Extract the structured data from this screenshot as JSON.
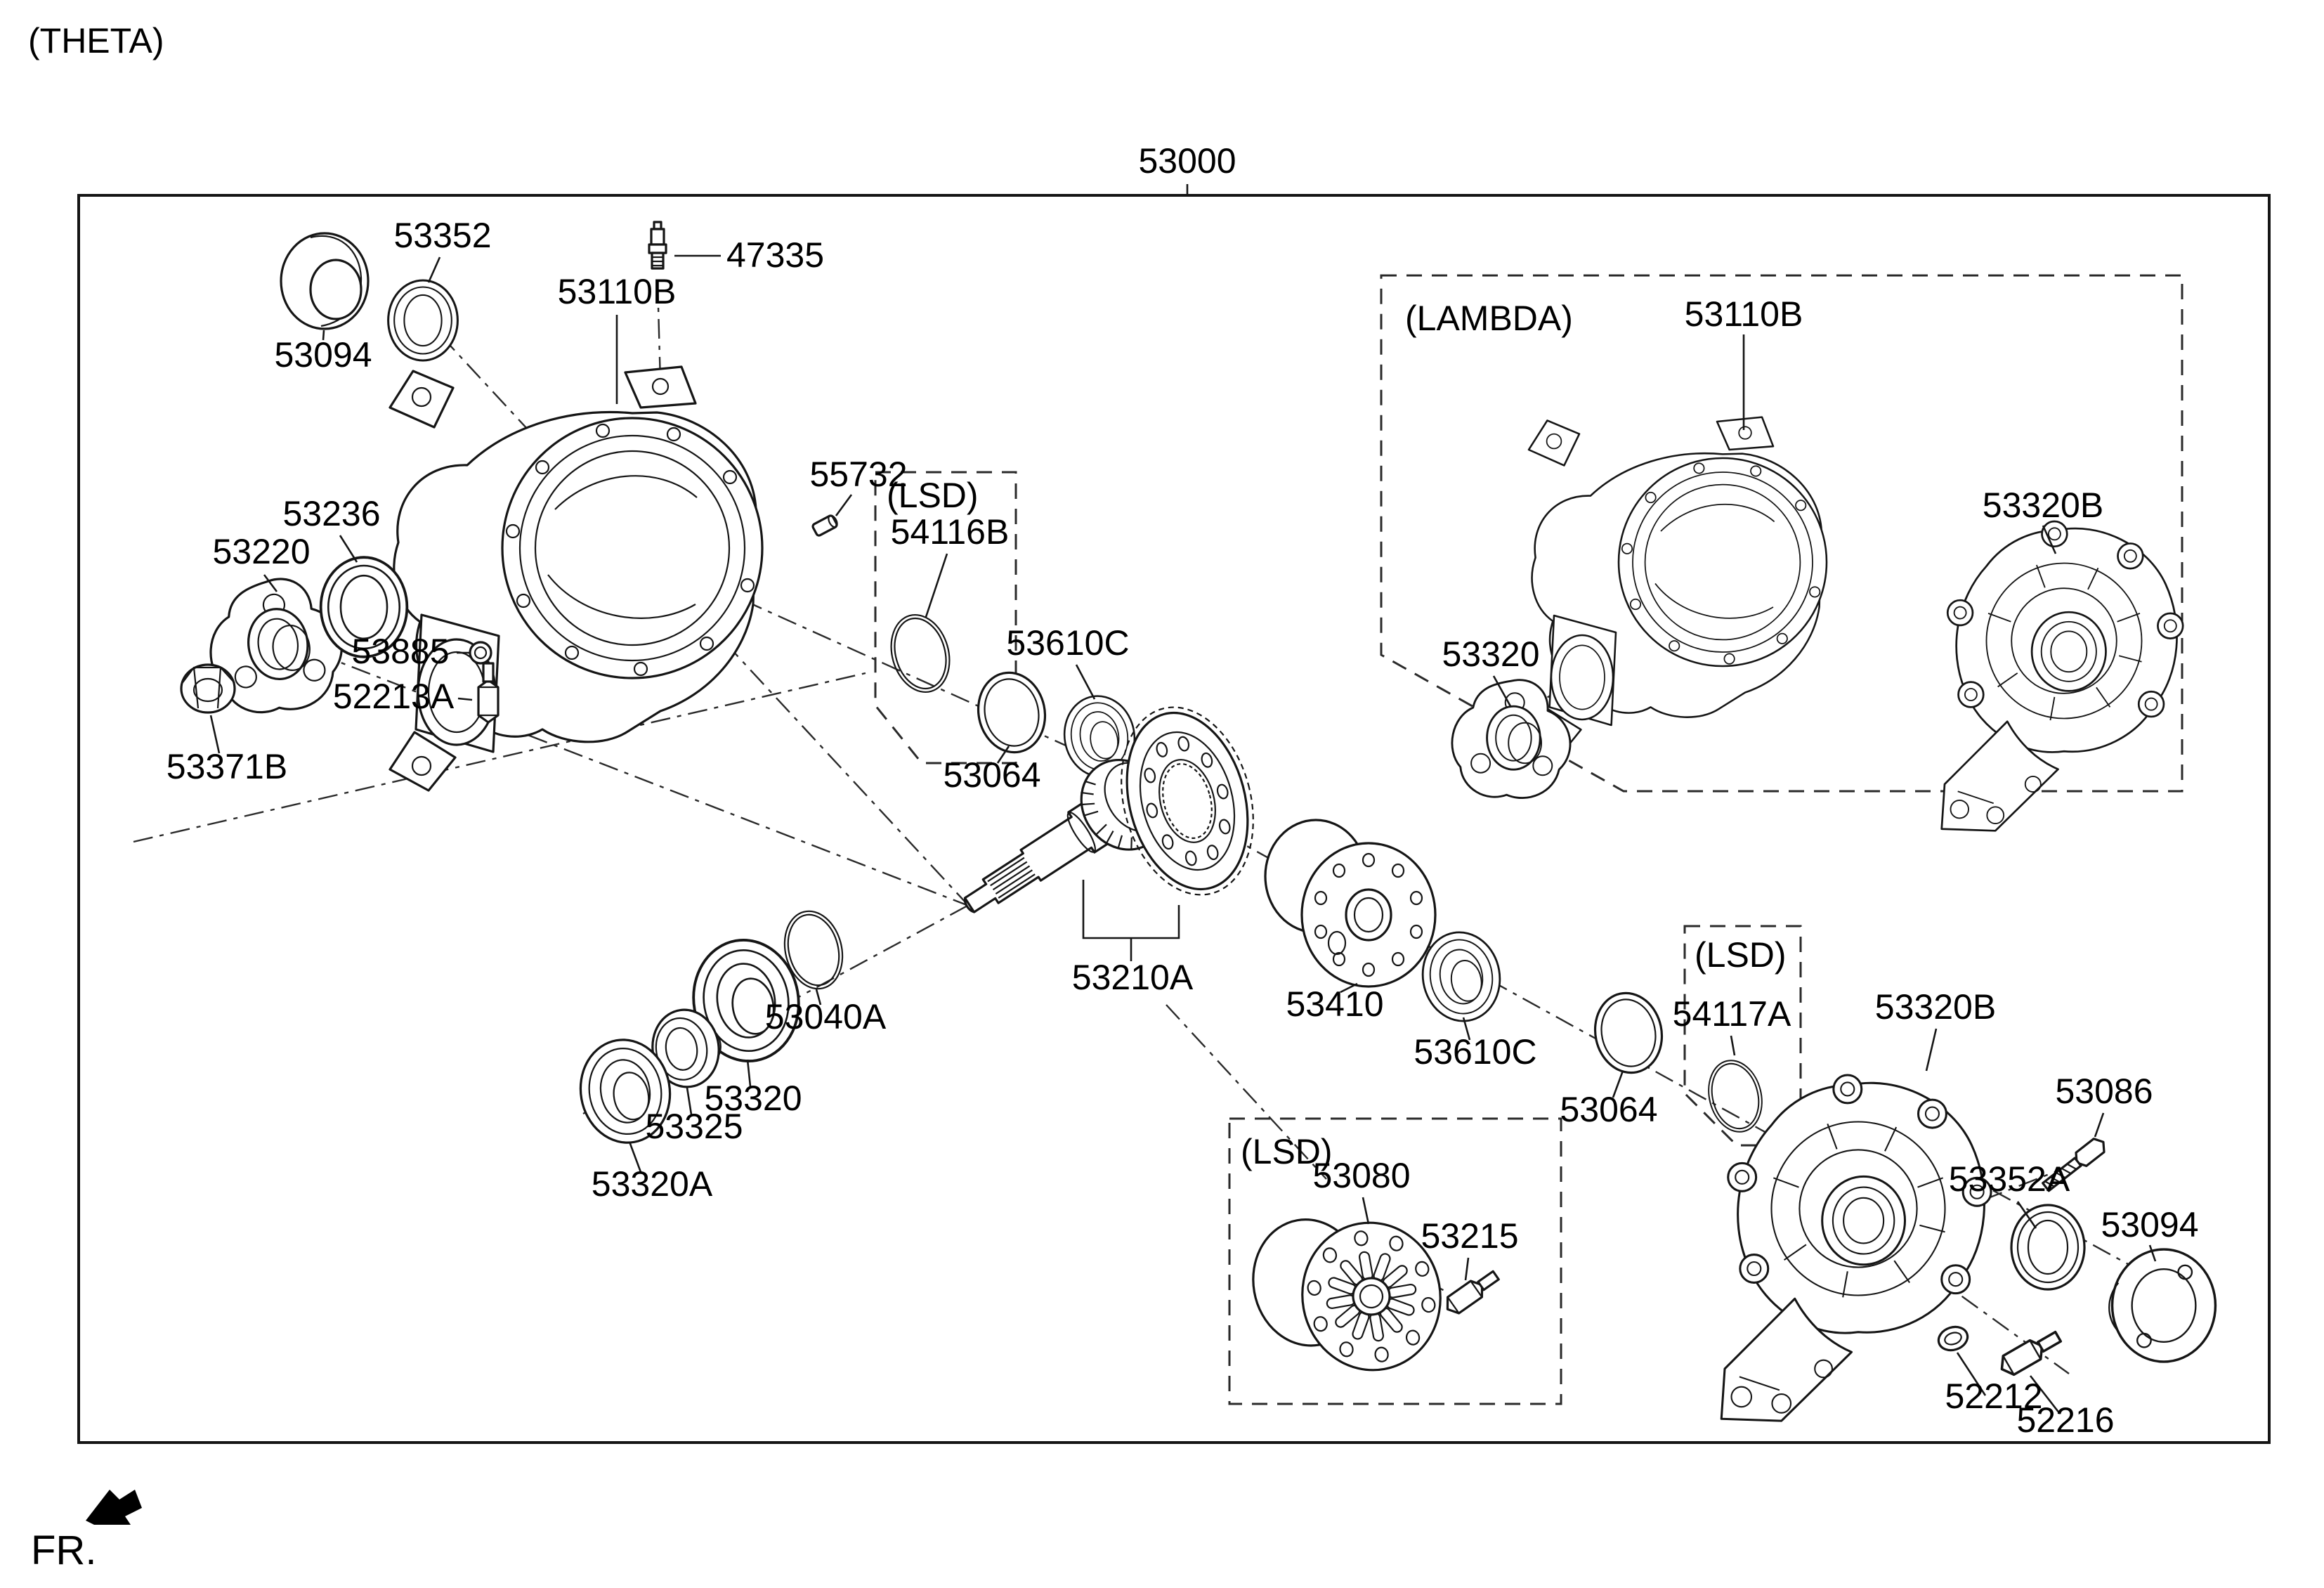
{
  "page": {
    "platform_variant": "(THETA)",
    "front_marker": "FR.",
    "ink_color": "#000000",
    "background_color": "#ffffff"
  },
  "assembly": {
    "part_no": "53000"
  },
  "option_boxes": {
    "lambda_label": "(LAMBDA)",
    "lsd_pinion_label": "(LSD)",
    "lsd_diff_label": "(LSD)",
    "lsd_case_label": "(LSD)"
  },
  "parts": {
    "seal_53352": "53352",
    "cap_53094_left": "53094",
    "breather_47335": "47335",
    "carrier_53110b_left": "53110B",
    "pin_55732": "55732",
    "oring_54116b": "54116B",
    "seal_53236": "53236",
    "flange_53220": "53220",
    "nut_53371b": "53371B",
    "washer_53885": "53885",
    "plug_52213a": "52213A",
    "spacer_53064_a": "53064",
    "bearing_53610c_a": "53610C",
    "carrier_53110b_lambda": "53110B",
    "cover_53320b_lambda": "53320B",
    "flange_53320_lambda": "53320",
    "gear_set_53210a": "53210A",
    "shim_53040a": "53040A",
    "bearing_53320_center": "53320",
    "spacer_53325": "53325",
    "bearing_53320a": "53320A",
    "diff_case_53410": "53410",
    "bearing_53610c_b": "53610C",
    "spacer_53064_b": "53064",
    "oring_54117a": "54117A",
    "cover_53320b_right": "53320B",
    "bolt_53086": "53086",
    "seal_53352a": "53352A",
    "cap_53094_right": "53094",
    "washer_52212": "52212",
    "plug_52216": "52216",
    "lsd_case_53080": "53080",
    "bolt_53215": "53215"
  }
}
